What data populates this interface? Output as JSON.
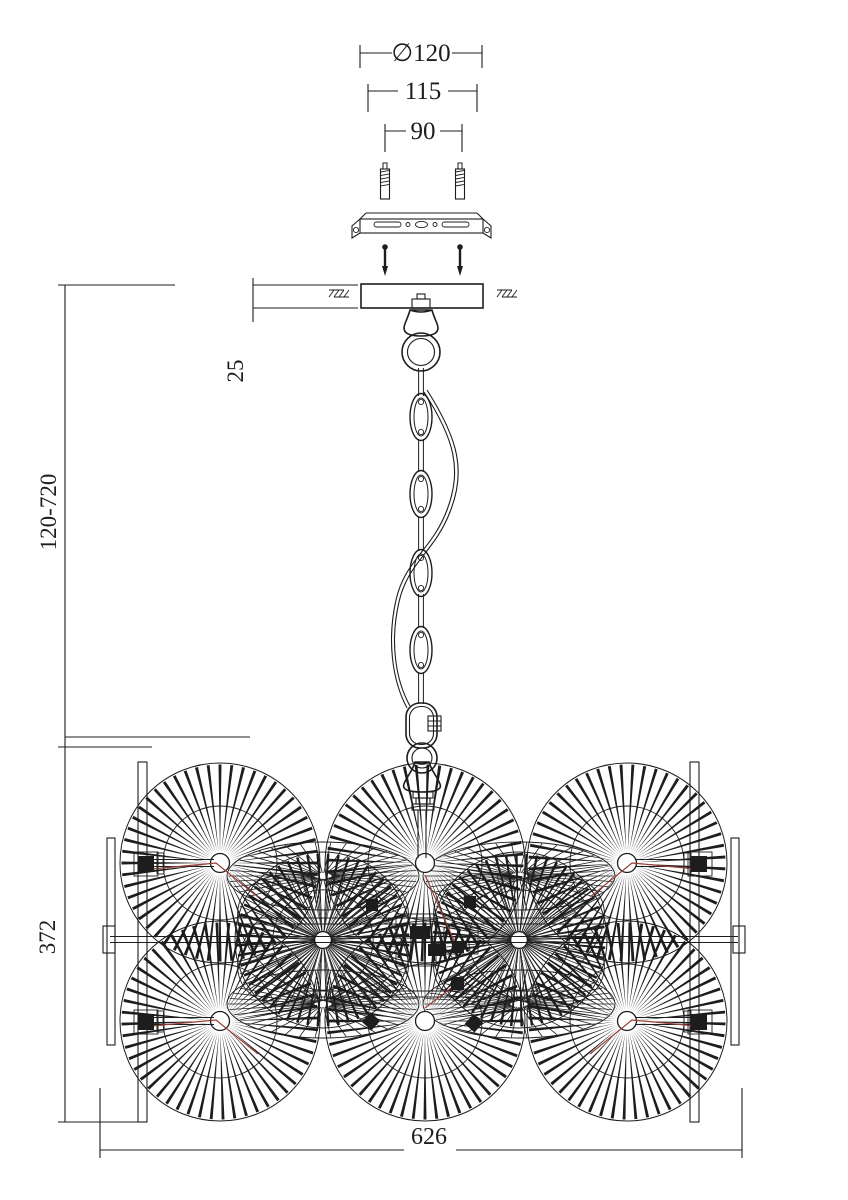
{
  "drawing_title": "Chandelier installation dimension diagram",
  "dims": {
    "canopy_diameter": "∅120",
    "bracket_width": "115",
    "hole_spacing": "90",
    "canopy_height": "25",
    "suspension_range": "120-720",
    "body_height": "372",
    "body_width": "626"
  },
  "colors": {
    "line": "#1d1d1d",
    "wire": "#993f36",
    "background": "#ffffff"
  }
}
